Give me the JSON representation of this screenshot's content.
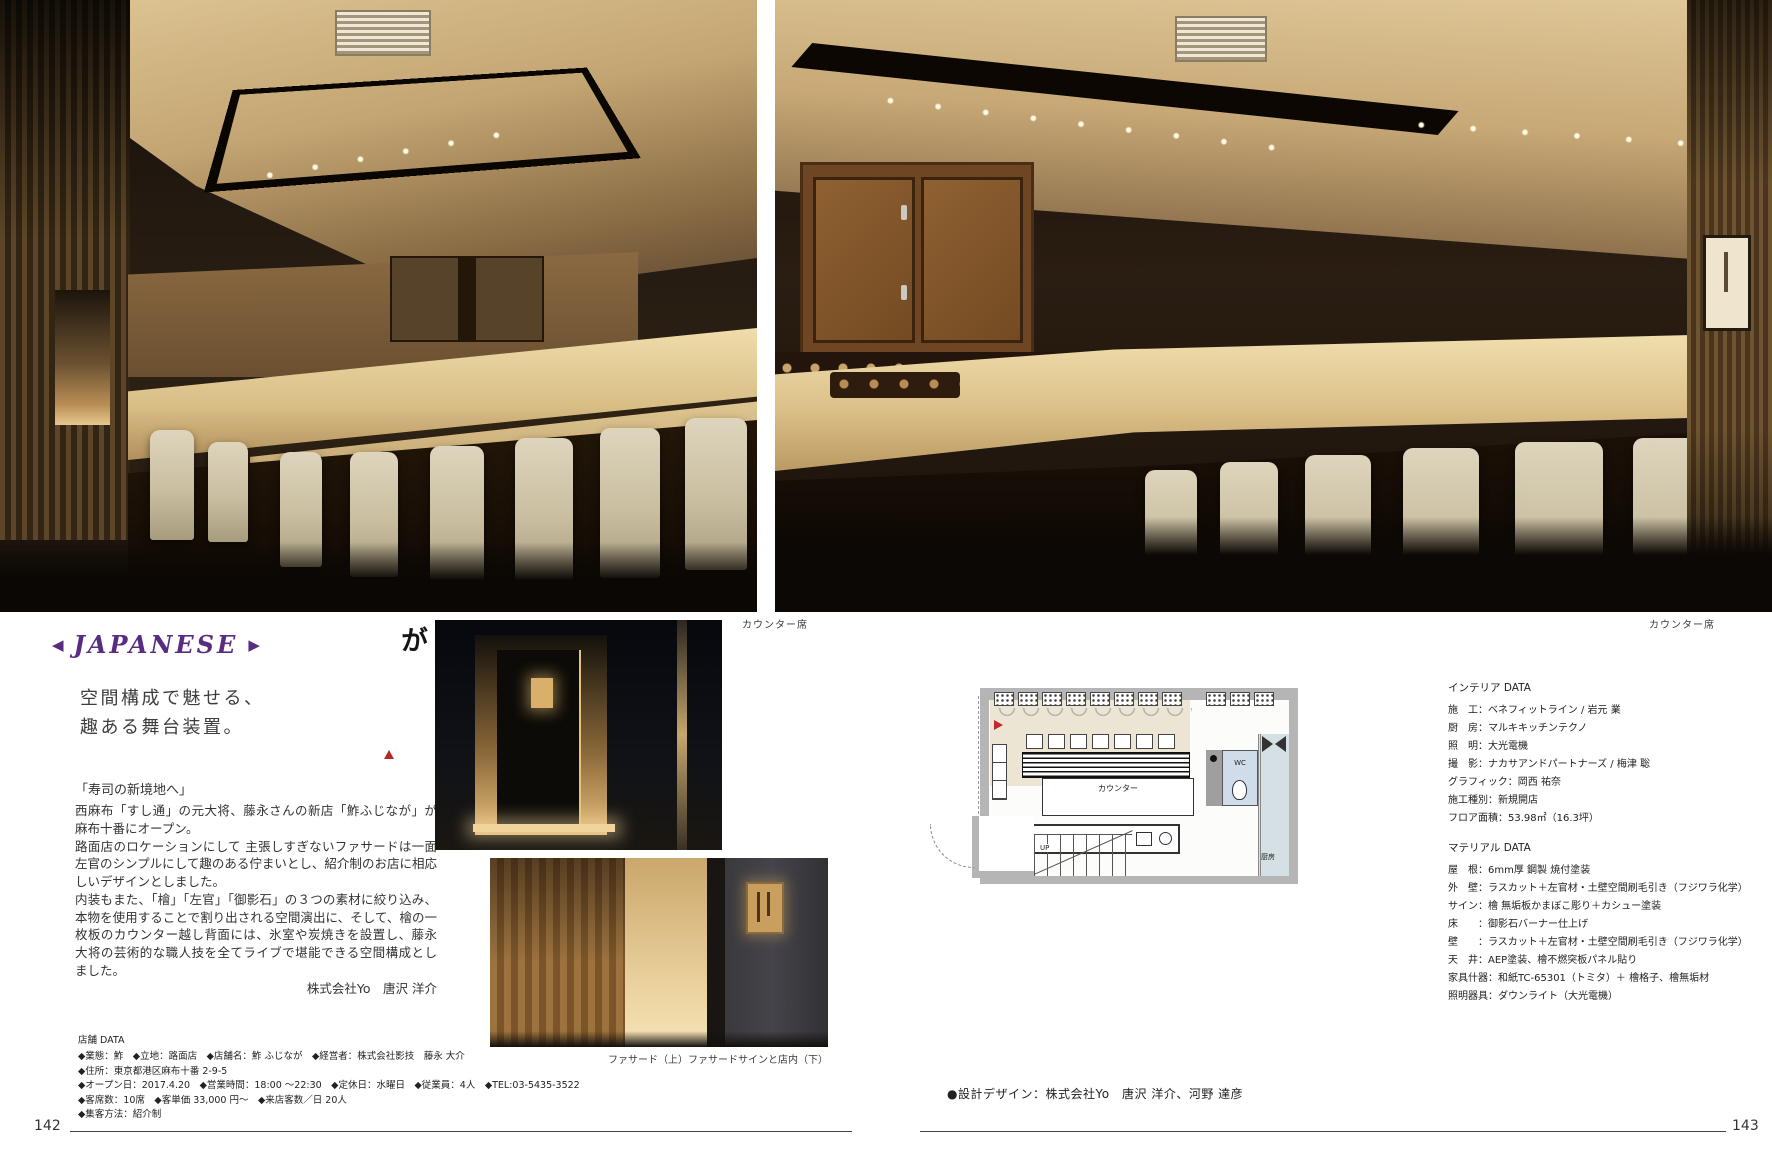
{
  "page": {
    "left_number": "142",
    "right_number": "143"
  },
  "category_header": {
    "label": "JAPANESE",
    "left_arrow": "◀",
    "right_arrow": "▶",
    "color": "#582c80"
  },
  "logo": {
    "vertical_text": "鮓ふじなが"
  },
  "headline": {
    "line1": "空間構成で魅せる、",
    "line2": "趣ある舞台装置。"
  },
  "photo_captions": {
    "main_left": "カウンター席",
    "main_right": "カウンター席",
    "middle": "ファサード（上）ファサードサインと店内（下）"
  },
  "article": {
    "lead": "「寿司の新境地へ」",
    "paragraphs": [
      "西麻布「すし通」の元大将、藤永さんの新店「鮓ふじなが」が麻布十番にオープン。",
      "路面店のロケーションにして 主張しすぎないファサードは一面左官のシンプルにして趣のある佇まいとし、紹介制のお店に相応しいデザインとしました。",
      "内装もまた、「檜」「左官」「御影石」の３つの素材に絞り込み、本物を使用することで割り出される空間演出に、そして、檜の一枚板のカウンター越し背面には、氷室や炭焼きを設置し、藤永大将の芸術的な職人技を全てライブで堪能できる空間構成としました。"
    ],
    "author_credit": "株式会社Yo　唐沢 洋介"
  },
  "shop_data": {
    "title": "店舗 DATA",
    "lines": [
      "◆業態：鮓　◆立地：路面店　◆店舗名：鮓 ふじなが　◆経営者：株式会社影技　藤永 大介",
      "◆住所：東京都港区麻布十番 2-9-5",
      "◆オープン日：2017.4.20　◆営業時間：18:00 ～22:30　◆定休日：水曜日　◆従業員：4人　◆TEL:03-5435-3522",
      "◆客席数：10席　◆客単価 33,000 円～　◆来店客数／日 20人",
      "◆集客方法：紹介制"
    ]
  },
  "floor_plan": {
    "labels": {
      "counter": "カウンター",
      "wc": "WC",
      "up": "UP",
      "kitchen": "厨房"
    }
  },
  "interior_data": {
    "title": "インテリア DATA",
    "lines": [
      "施　工：ベネフィットライン / 岩元 業",
      "厨　房：マルキキッチンテクノ",
      "照　明：大光電機",
      "撮　影：ナカサアンドパートナーズ / 梅津 聡",
      "グラフィック：岡西 祐奈",
      "施工種別：新規開店",
      "フロア面積：53.98㎡（16.3坪）"
    ]
  },
  "material_data": {
    "title": "マテリアル DATA",
    "lines": [
      "屋　根：6mm厚 鋼製 焼付塗装",
      "外　壁：ラスカット＋左官材・土壁空間刷毛引き（フジワラ化学）",
      "サイン：檜 無垢板かまぼこ彫り＋カシュー塗装",
      "床　　：御影石バーナー仕上げ",
      "壁　　：ラスカット＋左官材・土壁空間刷毛引き（フジワラ化学）",
      "天　井：AEP塗装、檜不燃突板パネル貼り",
      "家具什器：和紙TC-65301（トミタ）＋ 檜格子、檜無垢材",
      "照明器具：ダウンライト（大光電機）"
    ]
  },
  "design_credit": "●設計デザイン：株式会社Yo　唐沢 洋介、河野 達彦"
}
